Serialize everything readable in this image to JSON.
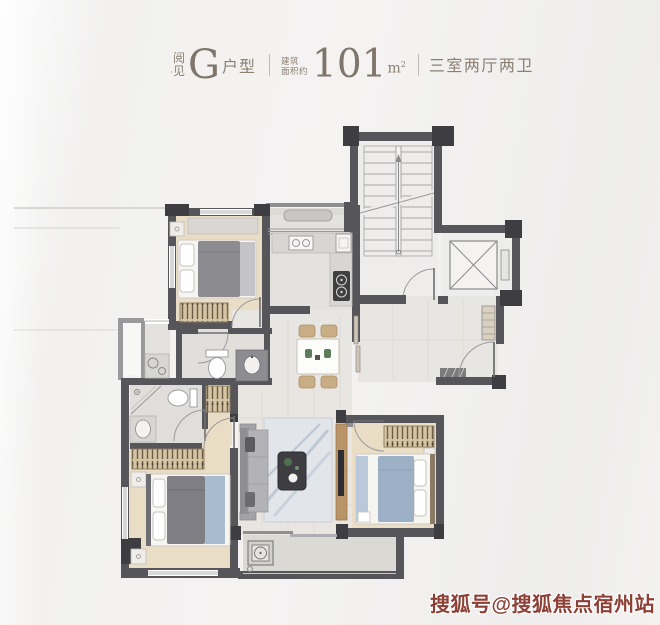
{
  "header": {
    "brand": {
      "line1": "阅",
      "separator": "·",
      "line2": "见"
    },
    "unit": {
      "letter": "G",
      "suffix": "户型"
    },
    "area": {
      "label_line1": "建筑",
      "label_line2": "面积约",
      "value": "101",
      "unit_base": "m",
      "unit_sup": "2"
    },
    "layout_text": "三室两厅两卫",
    "text_color": "#8b8072",
    "divider_color": "#c2bab0"
  },
  "watermark": {
    "text": "搜狐号@搜狐焦点宿州站",
    "color": "#8d4036"
  },
  "floorplan": {
    "colors": {
      "wall": "#56565a",
      "column": "#3e3e42",
      "wood_floor": "#e9ddc6",
      "tile_floor": "#e9e6e1",
      "bath_floor": "#dfdedb",
      "stair_floor": "#eeedeb",
      "balcony_floor": "#dbd9d4",
      "wardrobe": "#d6c5a4",
      "counter": "#d8d6d2",
      "duvet_gray": "#7f7f85",
      "duvet_blue": "#9db1c6",
      "tv_console_wood": "#b89468",
      "plant_green": "#4e7050"
    },
    "depicted_features": [
      "stairs",
      "elevator",
      "entry-door",
      "shoe-cabinet",
      "kitchen-counter",
      "sink",
      "stove",
      "fridge",
      "service-balcony",
      "dining-table",
      "chairs",
      "shared-bath-toilet",
      "vanity",
      "laundry-counter",
      "master-bath-shower",
      "master-bath-toilet",
      "wardrobes",
      "double-beds",
      "nightstands",
      "sofa",
      "coffee-table",
      "rug",
      "tv-console",
      "balcony",
      "ac-unit"
    ]
  }
}
